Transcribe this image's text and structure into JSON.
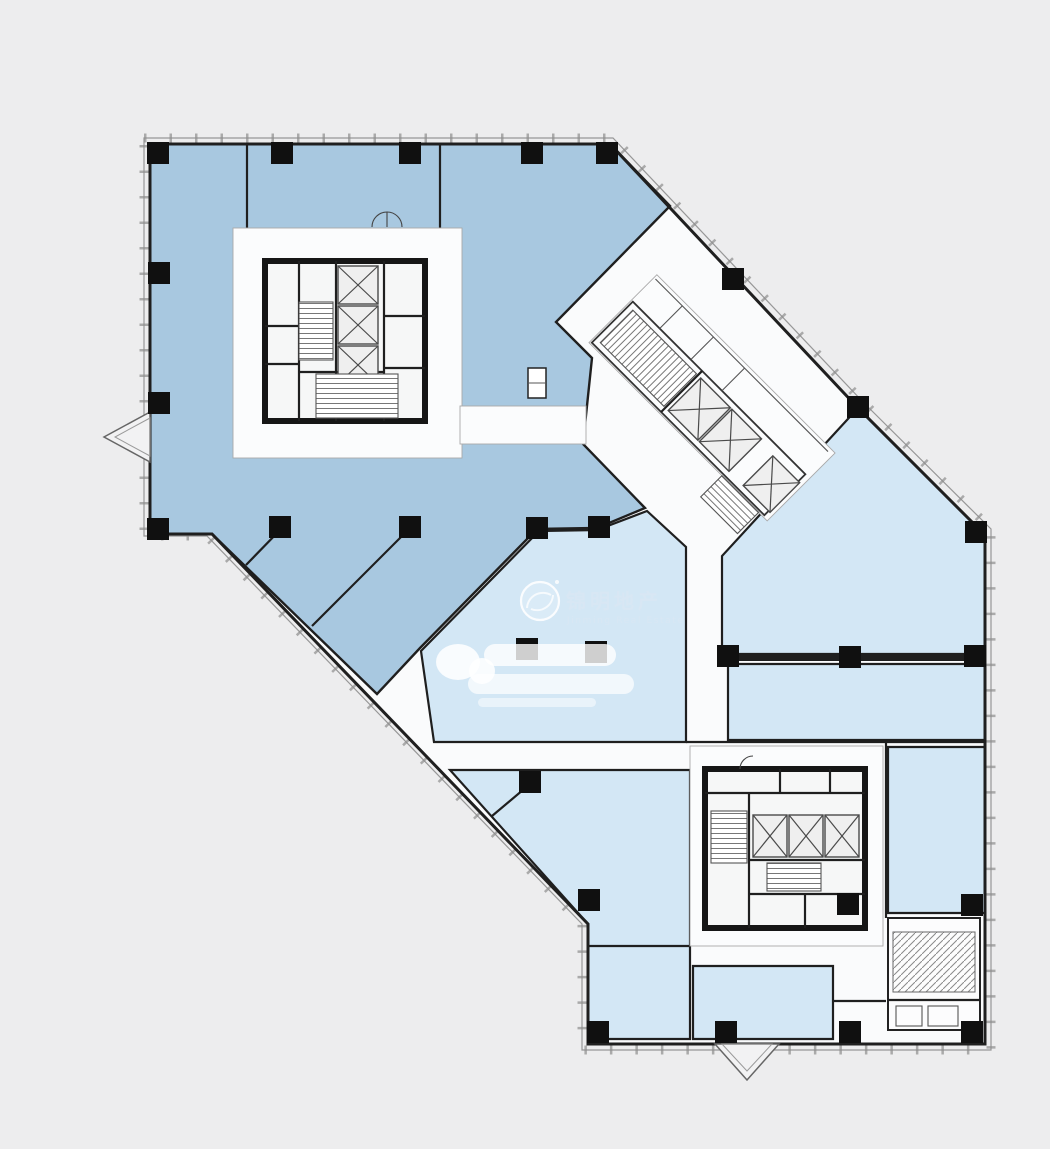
{
  "watermark": {
    "brand_cn": "锦明地产",
    "brand_en": "Jinming Real Estate"
  },
  "colors": {
    "background": "#ededee",
    "plan_bg": "#fafbfc",
    "zone_dark": "#a8c8e0",
    "zone_light": "#d3e7f5",
    "wall": "#1f1f1f",
    "column": "#101010",
    "mullion": "#999999",
    "hatch": "#777777",
    "watermark_text": "#d9e7f4",
    "watermark_white": "#ffffff"
  },
  "icons": {
    "elevator": "crossed-box",
    "stair": "tread-hatch",
    "bay_window": "triangle-bay",
    "logo": "swirl-circle"
  }
}
